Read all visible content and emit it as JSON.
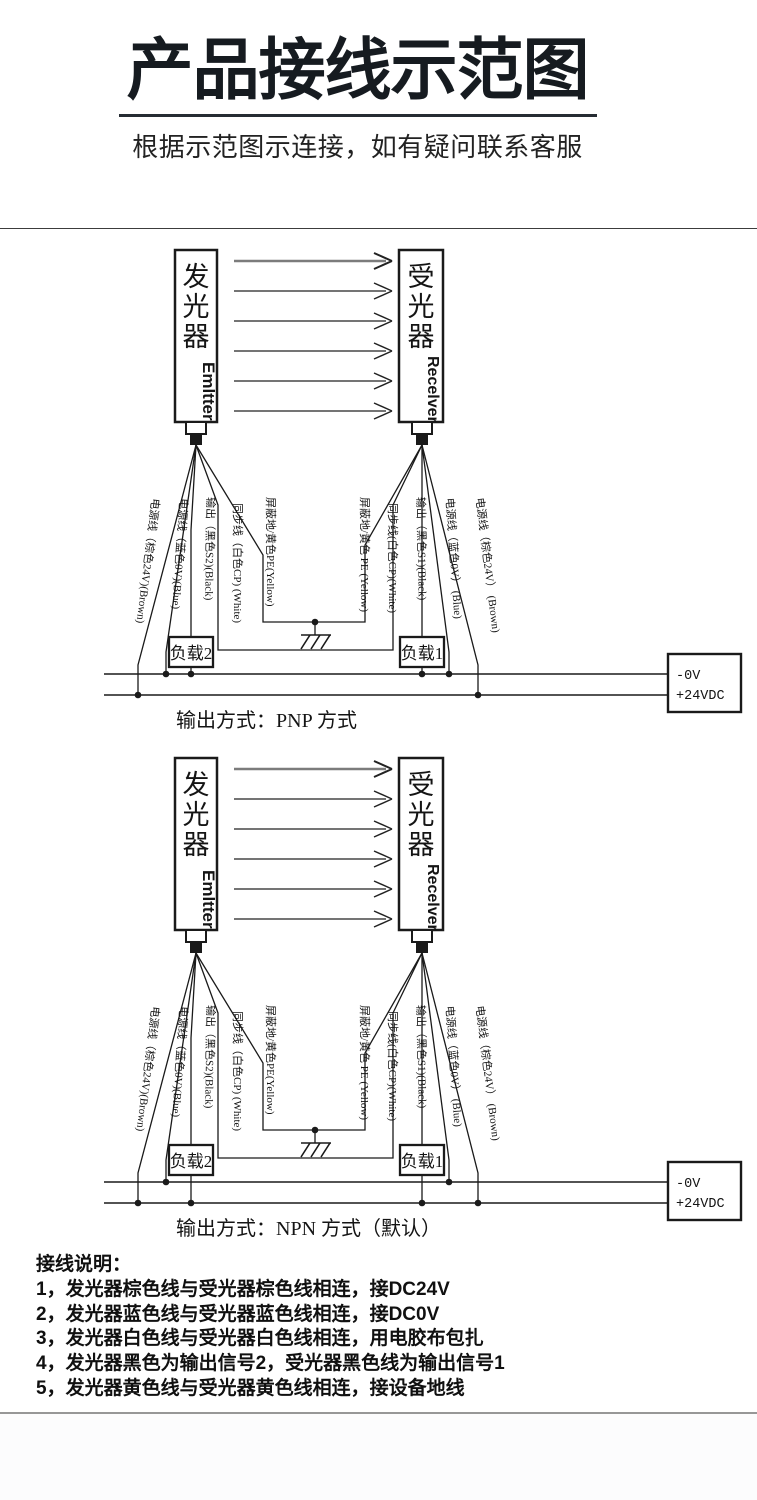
{
  "header": {
    "title": "产品接线示范图",
    "subtitle": "根据示范图示连接，如有疑问联系客服"
  },
  "diagrams": [
    {
      "emitter": {
        "cn": "发光器",
        "en": "Emltter"
      },
      "receiver": {
        "cn": "受光器",
        "en": "Recelver"
      },
      "wire_labels": {
        "emitter": [
          "电源线（棕色24V)(Brown)",
          "电源线（蓝色0V)(Blue)",
          "输出（黑色S2)(Black)",
          "同步线（白色CP) (White)",
          "屏蔽地/黄色PE(Yellow)"
        ],
        "receiver": [
          "屏蔽地/黄色 PE (Yellow)",
          "同步线(白色CP)(White)",
          "输出（黑色S1)(Black)",
          "电源线（蓝色0V） (Blue)",
          "电源线（棕色24V） (Brown)"
        ]
      },
      "loads": [
        "负载2",
        "负载1"
      ],
      "power_labels": [
        "-0V",
        "+24VDC"
      ],
      "caption": "输出方式：PNP 方式",
      "load_rail": "top"
    },
    {
      "emitter": {
        "cn": "发光器",
        "en": "Emltter"
      },
      "receiver": {
        "cn": "受光器",
        "en": "Recelver"
      },
      "wire_labels": {
        "emitter": [
          "电源线（棕色24V)(Brown)",
          "电源线（蓝色0V)(Blue)",
          "输出（黑色S2)(Black)",
          "同步线（白色CP) (White)",
          "屏蔽地/黄色PE(Yellow)"
        ],
        "receiver": [
          "屏蔽地/黄色 PE (Yellow)",
          "同步线(白色CP)(White)",
          "输出（黑色S1)(Black)",
          "电源线（蓝色0V） (Blue)",
          "电源线（棕色24V） (Brown)"
        ]
      },
      "loads": [
        "负载2",
        "负载1"
      ],
      "power_labels": [
        "-0V",
        "+24VDC"
      ],
      "caption": "输出方式：NPN 方式（默认）",
      "load_rail": "bottom"
    }
  ],
  "notes": {
    "heading": "接线说明：",
    "items": [
      "1，发光器棕色线与受光器棕色线相连，接DC24V",
      "2，发光器蓝色线与受光器蓝色线相连，接DC0V",
      "3，发光器白色线与受光器白色线相连，用电胶布包扎",
      "4，发光器黑色为输出信号2，受光器黑色线为输出信号1",
      "5，发光器黄色线与受光器黄色线相连，接设备地线"
    ]
  }
}
